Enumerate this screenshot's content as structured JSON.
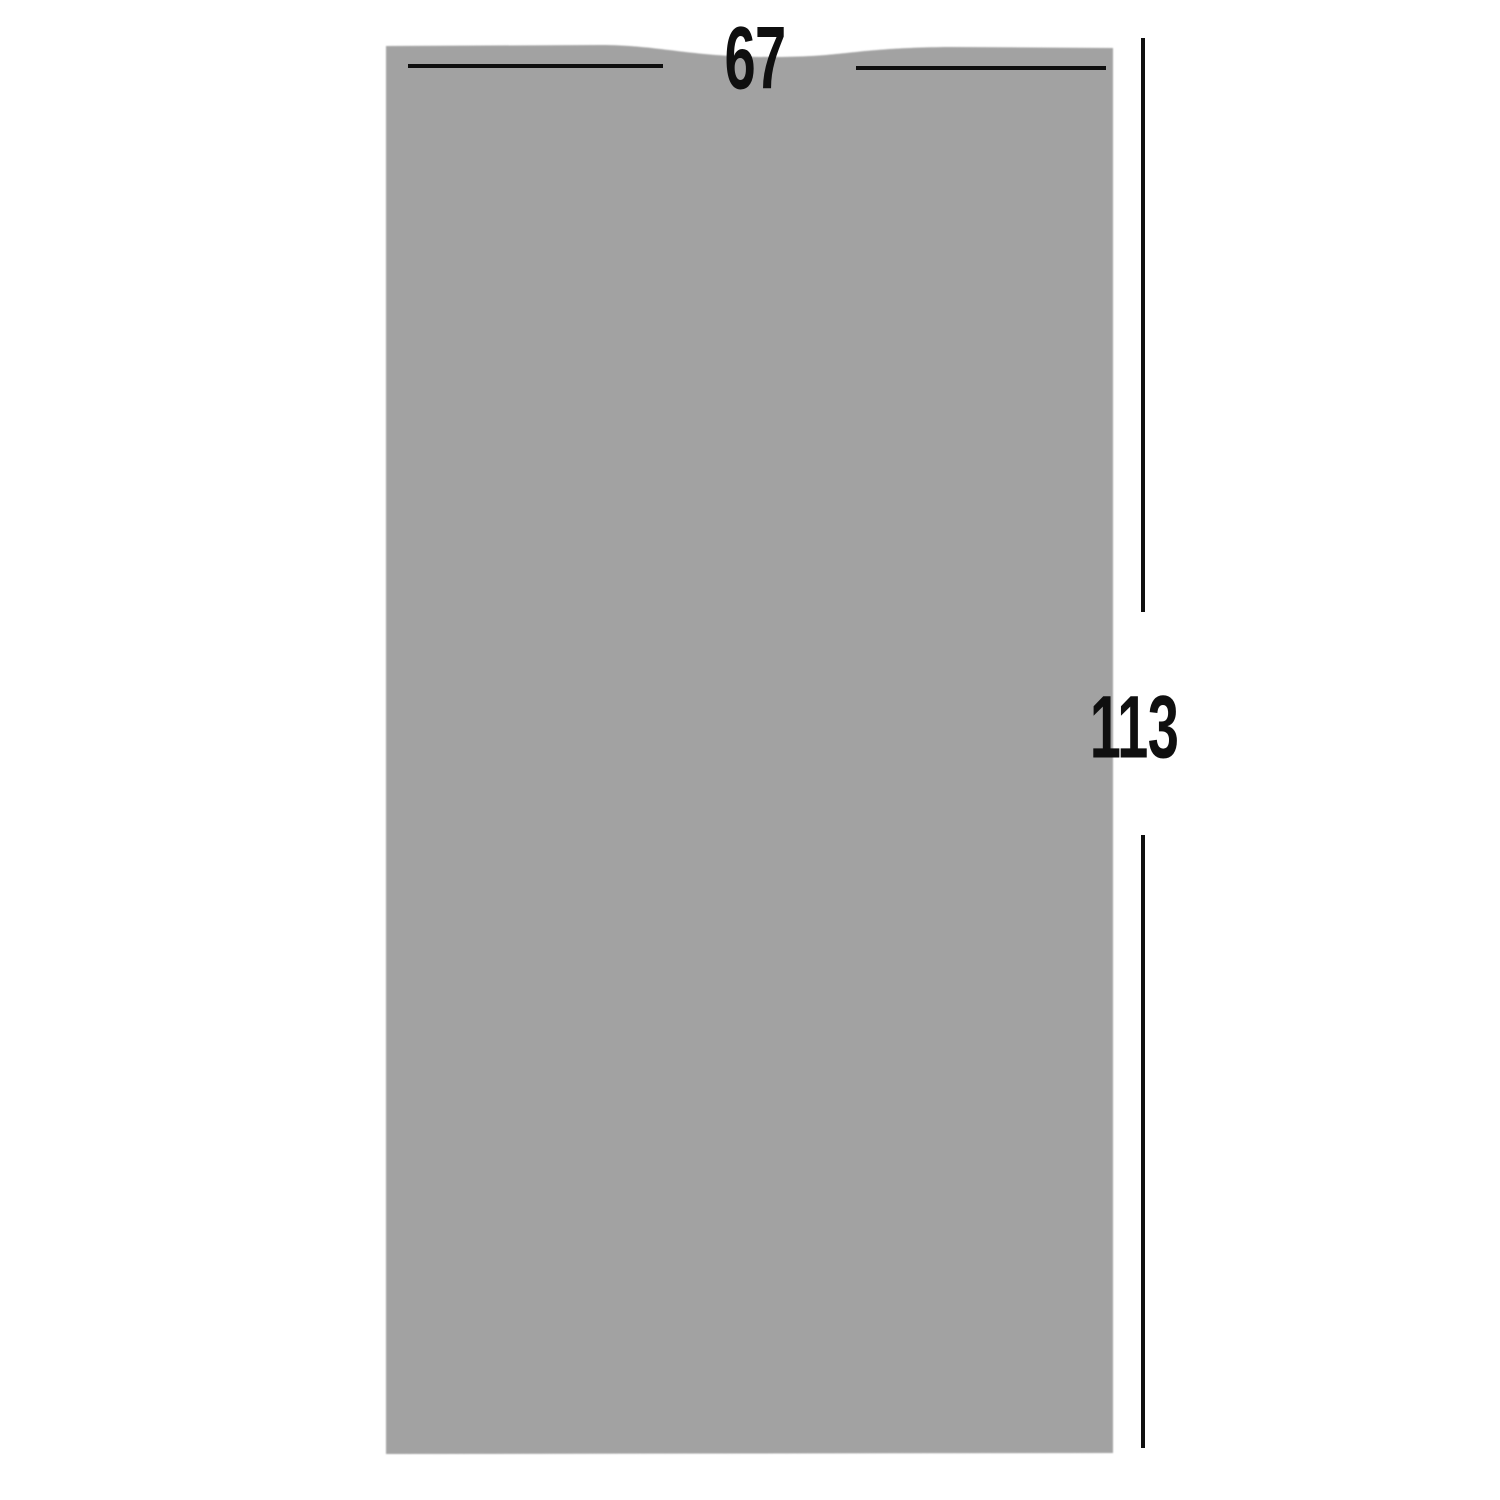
{
  "diagram": {
    "width_label": "67",
    "height_label": "113",
    "colors": {
      "silhouette": "#a2a2a2",
      "dimension_lines": "#0f0f0f",
      "background": "#ffffff"
    }
  }
}
